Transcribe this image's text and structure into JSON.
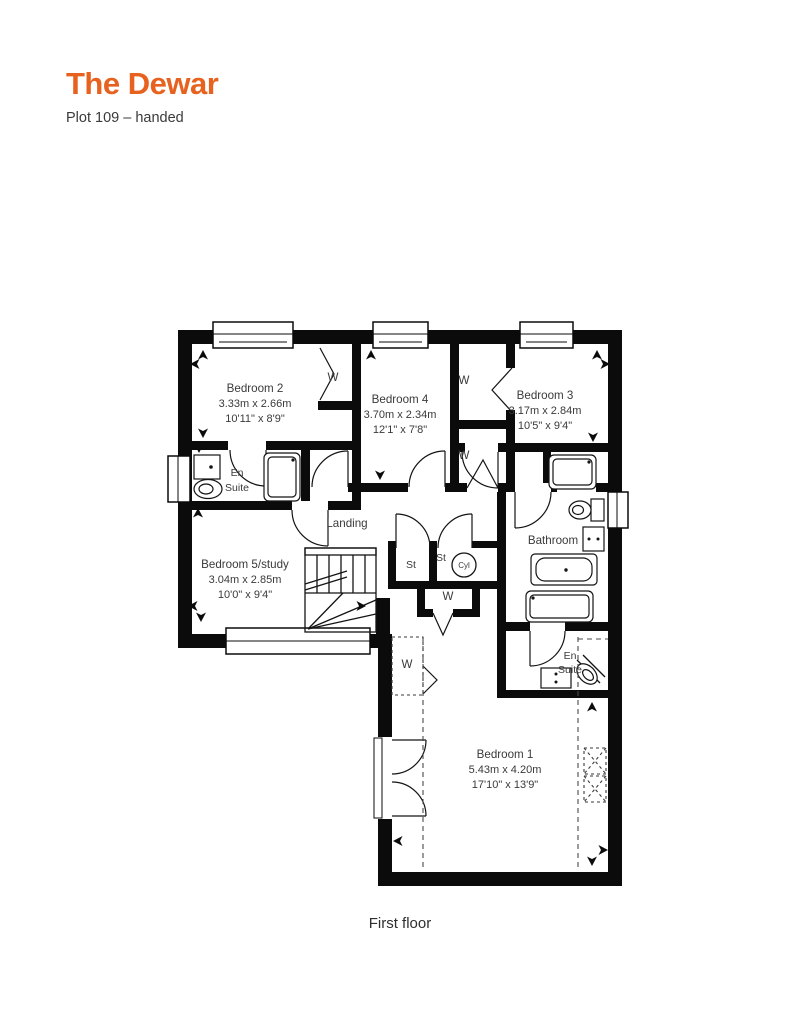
{
  "header": {
    "title": "The Dewar",
    "subtitle": "Plot 109 – handed"
  },
  "caption": "First floor",
  "colors": {
    "accent": "#e7611f",
    "wall": "#0b0b0b",
    "text": "#3a3a3a"
  },
  "glyphs": {
    "wardrobe": "W",
    "store": "St",
    "cylinder": "Cyl"
  },
  "rooms": {
    "bedroom2": {
      "name": "Bedroom 2",
      "metric": "3.33m x 2.66m",
      "imperial": "10'11\" x 8'9\""
    },
    "bedroom4": {
      "name": "Bedroom 4",
      "metric": "3.70m x 2.34m",
      "imperial": "12'1\" x 7'8\""
    },
    "bedroom3": {
      "name": "Bedroom 3",
      "metric": "3.17m x 2.84m",
      "imperial": "10'5\" x 9'4\""
    },
    "bedroom5": {
      "name": "Bedroom 5/study",
      "metric": "3.04m x 2.85m",
      "imperial": "10'0\" x 9'4\""
    },
    "bedroom1": {
      "name": "Bedroom 1",
      "metric": "5.43m x 4.20m",
      "imperial": "17'10\" x 13'9\""
    },
    "landing": {
      "name": "Landing"
    },
    "bathroom": {
      "name": "Bathroom"
    },
    "en_suite": {
      "line1": "En",
      "line2": "Suite"
    }
  }
}
